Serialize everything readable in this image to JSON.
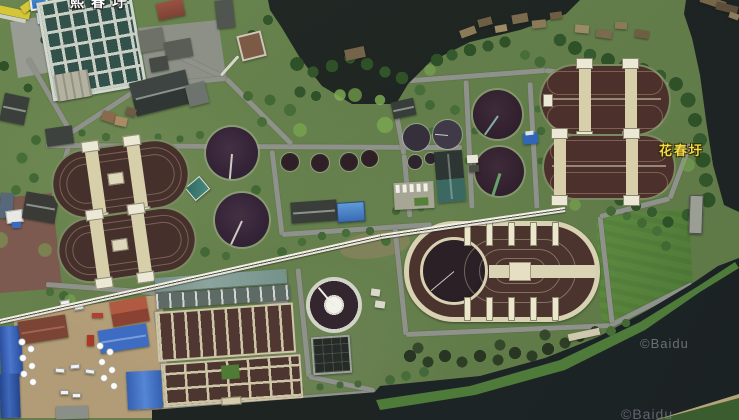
{
  "viewport": {
    "width": 739,
    "height": 420,
    "imagery": "satellite"
  },
  "labels": {
    "place_top": {
      "text": "熙春圩",
      "color": "#ffffff",
      "clipped": "top edge"
    },
    "place_right": {
      "text": "花春圩",
      "color": "#f2da4a"
    }
  },
  "watermarks": {
    "mid_right": {
      "text": "©Baidu"
    },
    "bottom_right": {
      "text": "©Baidu"
    }
  },
  "scene": {
    "description": "aerial view of a riverside wastewater treatment plant",
    "features": [
      "river water",
      "canal",
      "circular clarifier tanks",
      "oxidation ditch ovals",
      "aeration basin grid",
      "sedimentation tank grid",
      "pier",
      "industrial yard",
      "tree lines",
      "service roads",
      "elevated pipeline",
      "green field"
    ]
  },
  "palette": {
    "water": "#1e2422",
    "land_green": "#66814c",
    "tree_dark": "#2f5128",
    "grass_bright": "#7aa850",
    "road_gray": "#8f928a",
    "tank_dark": "#342433",
    "ditch_brown": "#46302c",
    "walkway_beige": "#d7cfa9",
    "roof_blue": "#3e6cc2",
    "roof_red": "#9a5242",
    "label_yellow": "#f2da4a",
    "watermark_gray": "#7d828a"
  }
}
